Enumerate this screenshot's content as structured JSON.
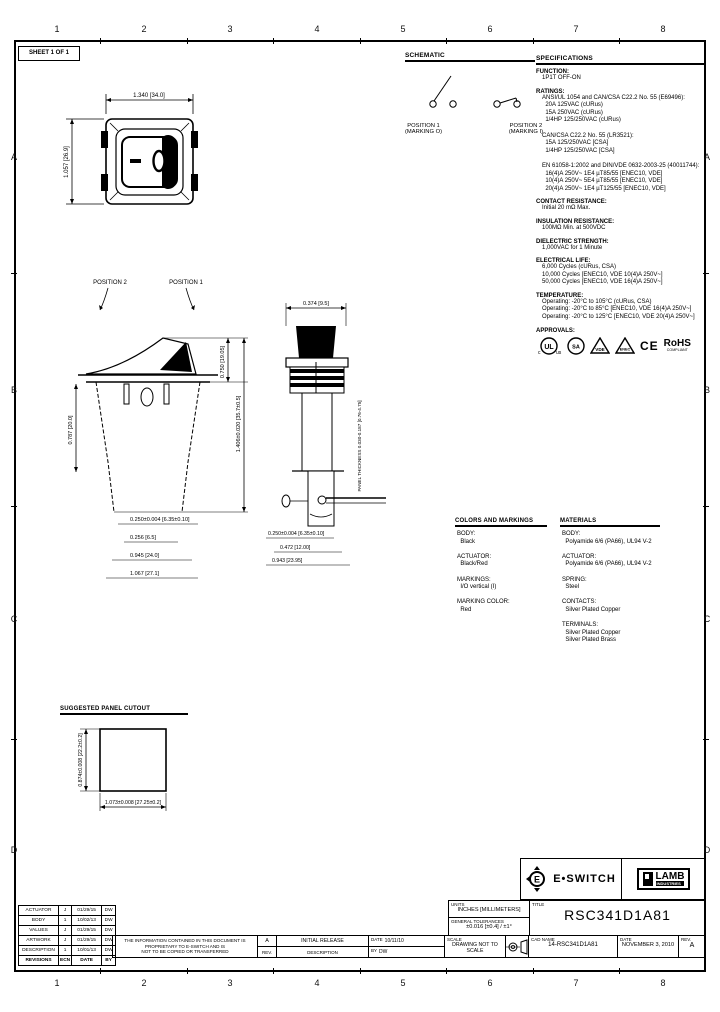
{
  "sheet": {
    "label": "SHEET 1 OF 1"
  },
  "zones": {
    "cols": [
      "1",
      "2",
      "3",
      "4",
      "5",
      "6",
      "7",
      "8"
    ],
    "rows": [
      "A",
      "B",
      "C",
      "D"
    ]
  },
  "schematic": {
    "title": "SCHEMATIC",
    "position1": {
      "label": "POSITION 1",
      "sub": "(MARKING O)"
    },
    "position2": {
      "label": "POSITION 2",
      "sub": "(MARKING I)"
    }
  },
  "specifications": {
    "title": "SPECIFICATIONS",
    "function": {
      "head": "FUNCTION:",
      "body": "1P1T OFF-ON"
    },
    "ratings": {
      "head": "RATINGS:",
      "body": "ANSI/UL 1054 and CAN/CSA C22.2 No. 55 (E69496):\n  20A 125VAC (cURus)\n  15A 250VAC (cURus)\n  1/4HP 125/250VAC (cURus)\n\nCAN/CSA C22.2 No. 55 (LR3521):\n  15A 125/250VAC [CSA]\n  1/4HP 125/250VAC [CSA]\n\nEN 61058-1:2002 and DIN/VDE 0632-2003-25 (40011744):\n  16(4)A 250V~ 1E4 µT85/55 [ENEC10, VDE]\n  10(4)A 250V~ 5E4 µT85/55 [ENEC10, VDE]\n  20(4)A 250V~ 1E4 µT125/55 [ENEC10, VDE]"
    },
    "contact_resistance": {
      "head": "CONTACT RESISTANCE:",
      "body": "Initial 20 mΩ Max."
    },
    "insulation_resistance": {
      "head": "INSULATION RESISTANCE:",
      "body": "100MΩ Min. at 500VDC"
    },
    "dielectric_strength": {
      "head": "DIELECTRIC STRENGTH:",
      "body": "1,000VAC for 1 Minute"
    },
    "electrical_life": {
      "head": "ELECTRICAL LIFE:",
      "body": "6,000 Cycles (cURus, CSA)\n10,000 Cycles [ENEC10, VDE 10(4)A 250V~]\n50,000 Cycles [ENEC10, VDE 16(4)A 250V~]"
    },
    "temperature": {
      "head": "TEMPERATURE:",
      "body": "Operating: -20°C to 105°C (cURus, CSA)\nOperating: -20°C to 85°C [ENEC10, VDE 16(4)A 250V~]\nOperating: -20°C to 125°C [ENEC10, VDE 20(4)A 250V~]"
    },
    "approvals": {
      "head": "APPROVALS:",
      "marks": [
        "cULus",
        "CSA",
        "VDE",
        "ENEC",
        "CE",
        "RoHS"
      ],
      "rohs_sub": "COMPLIANT"
    }
  },
  "colors_markings": {
    "title": "COLORS AND MARKINGS",
    "body": "BODY:\n  Black\n\nACTUATOR:\n  Black/Red\n\nMARKINGS:\n  I/O vertical (I)\n\nMARKING COLOR:\n  Red"
  },
  "materials": {
    "title": "MATERIALS",
    "body": "BODY:\n  Polyamide 6/6 (PA66), UL94 V-2\n\nACTUATOR:\n  Polyamide 6/6 (PA66), UL94 V-2\n\nSPRING:\n  Steel\n\nCONTACTS:\n  Silver Plated Copper\n\nTERMINALS:\n  Silver Plated Copper\n  Silver Plated Brass"
  },
  "views": {
    "front": {
      "dim_width": "1.340 [34.0]",
      "dim_height": "1.057 [26.9]"
    },
    "side": {
      "pos2": "POSITION 2",
      "pos1": "POSITION 1",
      "dim_right_1": "0.750 [19.05]",
      "dim_right_2": "1.406±0.020 [35.7±0.5]",
      "dim_left": "0.787 [20.0]",
      "dims_bottom": [
        "0.250±0.004 [6.35±0.10]",
        "0.256 [6.5]",
        "0.945 [24.0]",
        "1.067 [27.1]"
      ]
    },
    "profile": {
      "dim_top": "0.374 [9.5]",
      "note_right": "PANEL THICKNESS 0.030-0.187 [0.76-4.75]",
      "dims_bottom": [
        "0.250±0.004 [6.35±0.10]",
        "0.472 [12.00]",
        "0.943 [23.95]"
      ]
    },
    "cutout": {
      "title": "SUGGESTED PANEL CUTOUT",
      "dim_width": "1.073±0.008 [27.25±0.2]",
      "dim_height": "0.874±0.008 [22.2±0.2]"
    }
  },
  "title_block": {
    "eswitch_logo": "E•SWITCH",
    "lamb_logo": "LAMB",
    "lamb_sub": "INDUSTRIES",
    "units_label": "UNITS",
    "units_value": "INCHES [MILLIMETERS]",
    "tol_label": "GENERAL TOLERANCES",
    "tol_value": "±0.016 [±0.4] / ±1°",
    "title_label": "TITLE",
    "title_value": "RSC341D1A81",
    "scale_label": "SCALE",
    "scale_value": "DRAWING NOT TO SCALE",
    "projection_label": "PROJECTION",
    "cad_label": "CAD NAME",
    "cad_value": "14-RSC341D1A81",
    "date_label": "DATE",
    "date_value": "NOVEMBER 3, 2010",
    "rev_label": "REV.",
    "rev_value": "A",
    "drawn_date_label": "DATE",
    "drawn_date_value": "10/11/10",
    "drawn_by_label": "BY",
    "drawn_by_value": "DW",
    "entry_rev": "A",
    "entry_rev_label": "REV.",
    "entry_desc": "INITIAL RELEASE",
    "entry_desc_label": "DESCRIPTION",
    "disclaimer_line1": "THE INFORMATION CONTAINED IN THIS DOCUMENT IS PROPRIETARY TO E-SWITCH AND IS",
    "disclaimer_line2": "NOT TO BE COPIED OR TRANSFERRED"
  },
  "revision_table": {
    "rows": [
      [
        "ACTUATOR",
        "J",
        "01/29/15",
        "DW"
      ],
      [
        "BODY",
        "1",
        "10/02/13",
        "DW"
      ],
      [
        "VALUES",
        "J",
        "01/29/15",
        "DW"
      ],
      [
        "ARTWORK",
        "J",
        "01/29/15",
        "DW"
      ],
      [
        "DESCRIPTION",
        "1",
        "10/01/13",
        "DW"
      ],
      [
        "REVISIONS",
        "ECN",
        "DATE",
        "BY"
      ]
    ]
  }
}
